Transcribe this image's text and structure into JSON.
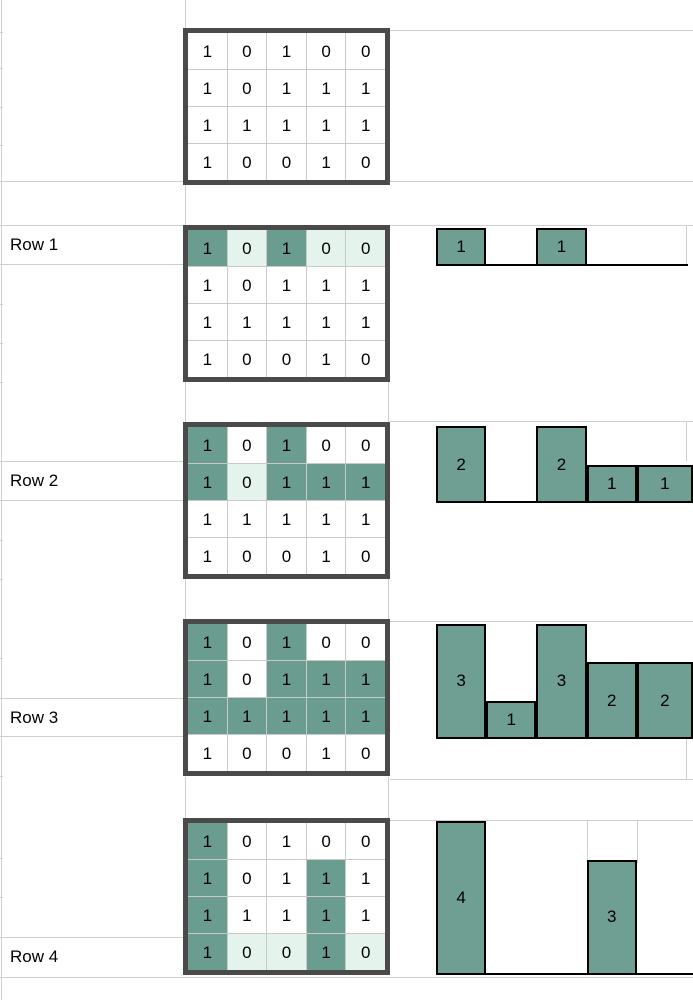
{
  "colors": {
    "bar_fill": "#6f9e93",
    "cell_highlight_dark": "#6b9c90",
    "cell_highlight_light": "#e4f4ec",
    "matrix_border": "#4a4a4a",
    "grid_line": "#cfcfcf",
    "bar_border": "#000000",
    "text": "#000000"
  },
  "matrix_values": [
    [
      1,
      0,
      1,
      0,
      0
    ],
    [
      1,
      0,
      1,
      1,
      1
    ],
    [
      1,
      1,
      1,
      1,
      1
    ],
    [
      1,
      0,
      0,
      1,
      0
    ]
  ],
  "sections": [
    {
      "name": "initial-matrix",
      "label": "",
      "highlight": [
        "wwwww",
        "wwwww",
        "wwwww",
        "wwwww"
      ],
      "histogram": null
    },
    {
      "name": "row-1",
      "label": "Row 1",
      "highlight": [
        "dldll",
        "wwwww",
        "wwwww",
        "wwwww"
      ],
      "histogram": [
        1,
        0,
        1,
        0,
        0
      ]
    },
    {
      "name": "row-2",
      "label": "Row 2",
      "highlight": [
        "dwdww",
        "dlddd",
        "wwwww",
        "wwwww"
      ],
      "histogram": [
        2,
        0,
        2,
        1,
        1
      ]
    },
    {
      "name": "row-3",
      "label": "Row 3",
      "highlight": [
        "dwdww",
        "dwddd",
        "ddddd",
        "wwwww"
      ],
      "histogram": [
        3,
        1,
        3,
        2,
        2
      ]
    },
    {
      "name": "row-4",
      "label": "Row 4",
      "highlight": [
        "dwwww",
        "dwwdw",
        "dwwdw",
        "dlldl"
      ],
      "histogram": [
        4,
        0,
        0,
        3,
        0
      ]
    }
  ],
  "chart_data": [
    {
      "type": "bar",
      "title": "Row 1",
      "values": [
        1,
        0,
        1,
        0,
        0
      ],
      "bar_labels": [
        "1",
        "",
        "1",
        "",
        ""
      ],
      "ylim": [
        0,
        1
      ]
    },
    {
      "type": "bar",
      "title": "Row 2",
      "values": [
        2,
        0,
        2,
        1,
        1
      ],
      "bar_labels": [
        "2",
        "",
        "2",
        "1",
        "1"
      ],
      "ylim": [
        0,
        2
      ]
    },
    {
      "type": "bar",
      "title": "Row 3",
      "values": [
        3,
        1,
        3,
        2,
        2
      ],
      "bar_labels": [
        "3",
        "1",
        "3",
        "2",
        "2"
      ],
      "ylim": [
        0,
        3
      ]
    },
    {
      "type": "bar",
      "title": "Row 4",
      "values": [
        4,
        0,
        0,
        3,
        0
      ],
      "bar_labels": [
        "4",
        "",
        "",
        "3",
        ""
      ],
      "ylim": [
        0,
        4
      ]
    }
  ]
}
